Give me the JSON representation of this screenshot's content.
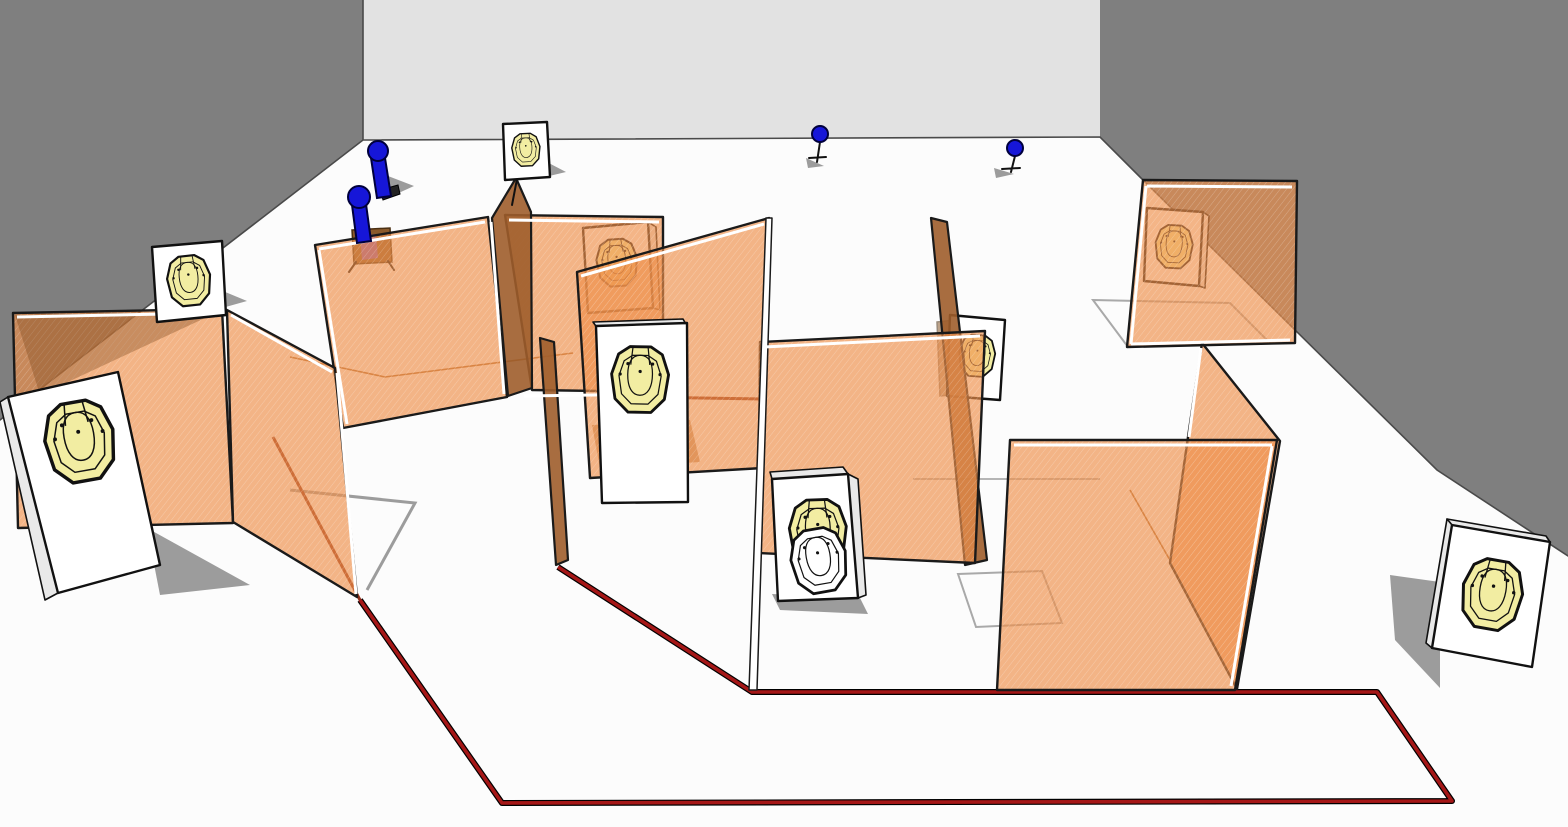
{
  "colors": {
    "floor": "#fcfcfc",
    "wall-side": "#7f7f7f",
    "wall-back": "#e2e2e2",
    "boundary": "#4a4a4a",
    "mesh": "rgba(238,142,73,0.66)",
    "mesh-line": "rgba(255,255,255,0.28)",
    "edge-face": "rgba(158,93,43,0.9)",
    "frame": "#1a1a1a",
    "rail": "#ffffff",
    "panel": "#ffffff",
    "panel-side": "#e9e9e9",
    "yellow": "#f2eda2",
    "ink": "#111111",
    "blue": "#1616d8",
    "blue-dark": "#00003c",
    "fault": "#a51717",
    "fault-edge": "#000000",
    "fault-hidden": "#8f3018",
    "shadow": "#9c9c9c",
    "shadow-tan": "#bc8a5c",
    "floor-line": "#b06f38",
    "gray-outline": "#a9a9a9",
    "stand-brown": "#8b5a2b",
    "stand-purple": "#8a56b0"
  },
  "scene": {
    "kind": "3d-shooting-stage-render",
    "room": {
      "left_wall_color_key": "wall-side",
      "back_wall_color_key": "wall-back",
      "right_wall_color_key": "wall-side",
      "floor_color_key": "floor"
    },
    "mesh_wall_count": 10,
    "paper_targets": [
      "target-big-left",
      "target-small-left",
      "target-top-center",
      "target-center-front",
      "target-behind-center-wall",
      "target-behind-right-wall",
      "target-beside-edge-wall",
      "target-stack-rear-yellow",
      "target-stack-front-no-shoot",
      "target-far-right"
    ],
    "poppers": [
      "popper-large-upper",
      "popper-large-lower"
    ],
    "mini_poppers": [
      "mini-popper-center",
      "mini-popper-right"
    ],
    "fault_line_points": [
      [
        360,
        600
      ],
      [
        502,
        803
      ],
      [
        1452,
        801
      ],
      [
        1377,
        692
      ],
      [
        752,
        692
      ],
      [
        558,
        567
      ]
    ],
    "hidden_fault_segments": [
      [
        [
          273,
          437
        ],
        [
          360,
          600
        ]
      ],
      [
        [
          637,
          397
        ],
        [
          767,
          399
        ]
      ]
    ]
  }
}
